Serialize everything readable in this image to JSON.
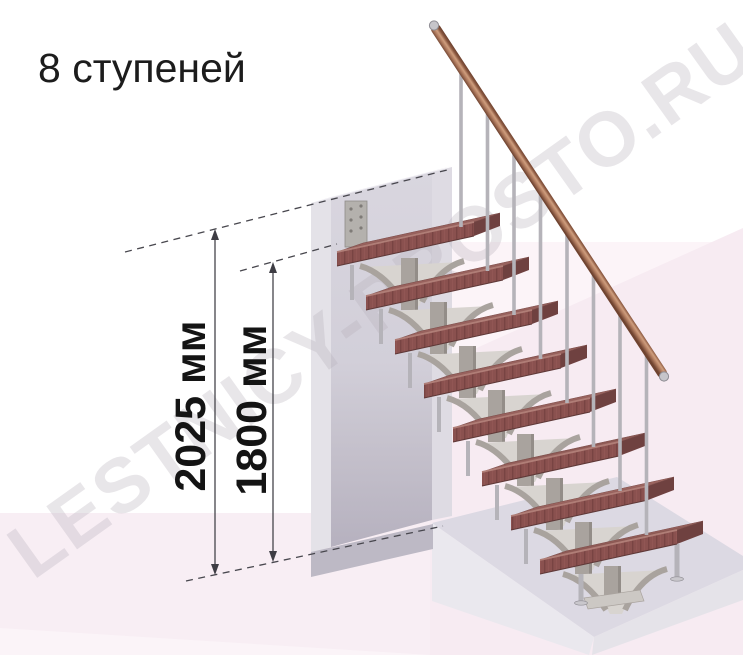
{
  "title": "8 ступеней",
  "watermark": "LESTNICY-PROSTO.RU",
  "diagram": {
    "steps_count": 8,
    "dimensions": [
      {
        "label": "2025 мм"
      },
      {
        "label": "1800 мм"
      }
    ],
    "colors": {
      "tread_top": "#97615d",
      "tread_top_stripe1": "#8c5954",
      "tread_top_stripe2": "#9e6761",
      "tread_front": "#8a514f",
      "tread_front_stripe": "#784443",
      "tread_side": "#6f4140",
      "tread_edge_highlight": "#b07e77",
      "tread_edge_dark": "#5e3837",
      "rail_dark": "#6f4330",
      "rail_mid": "#b58063",
      "rail_light": "#cf9e7e",
      "rail_cap": "#c6c5ca",
      "frame": "#a9a39e",
      "frame_web": "#d8d4d0",
      "frame_shade": "#938d88",
      "baluster": "#b5b3b9",
      "foot": "#c9c7cc",
      "plate": "#ccc8c4",
      "dim_line": "#46454c",
      "arrow": "#3e3d44"
    }
  }
}
